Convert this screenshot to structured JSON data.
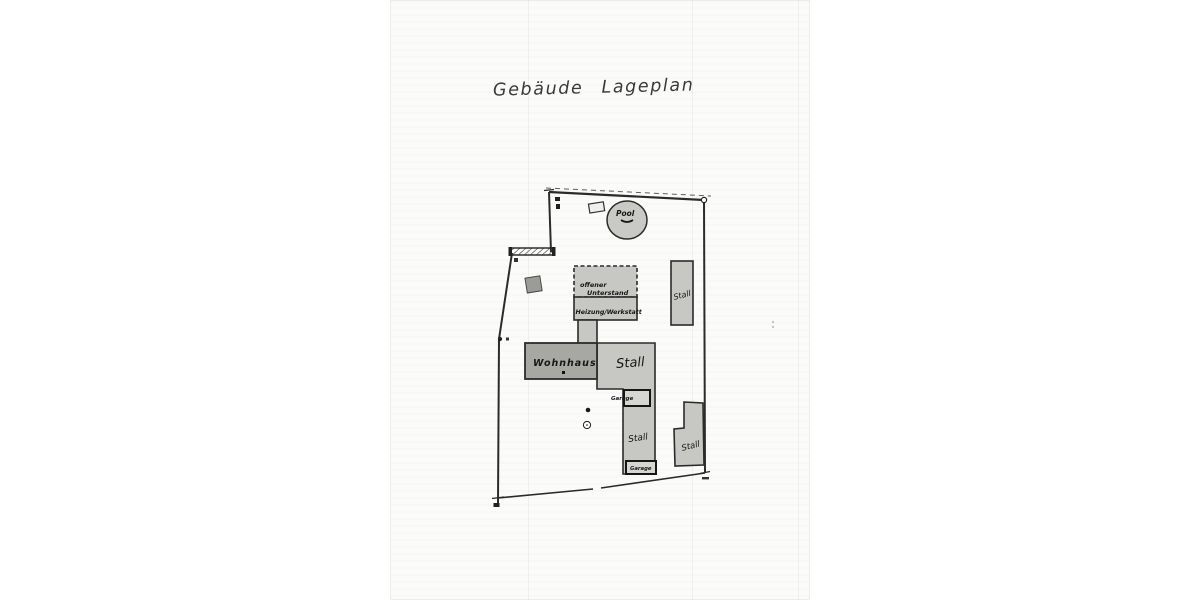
{
  "document": {
    "title": "Gebäude Lageplan"
  },
  "plan": {
    "buildings": [
      {
        "id": "pool",
        "label": "Pool"
      },
      {
        "id": "offener-unterstand",
        "lines": [
          "offener",
          "Unterstand"
        ]
      },
      {
        "id": "heizung-werkstatt",
        "label": "Heizung/Werkstatt"
      },
      {
        "id": "wohnhaus",
        "label": "Wohnhaus"
      },
      {
        "id": "stall-center",
        "label": "Stall"
      },
      {
        "id": "garage-upper",
        "label": "Garage"
      },
      {
        "id": "stall-south",
        "label": "Stall"
      },
      {
        "id": "garage-lower",
        "label": "Garage"
      },
      {
        "id": "stall-east",
        "label": "Stall"
      },
      {
        "id": "stall-southeast",
        "label": "Stall"
      }
    ],
    "colors": {
      "paper": "#fbfbfa",
      "ink": "#2b2b2b",
      "building_fill": "#c7c7c4",
      "wohnhaus_fill": "#a7a7a4",
      "pool_fill": "#c9c9c6",
      "garage_fill": "#d6d6d3",
      "square_fill": "#9b9b98"
    }
  }
}
